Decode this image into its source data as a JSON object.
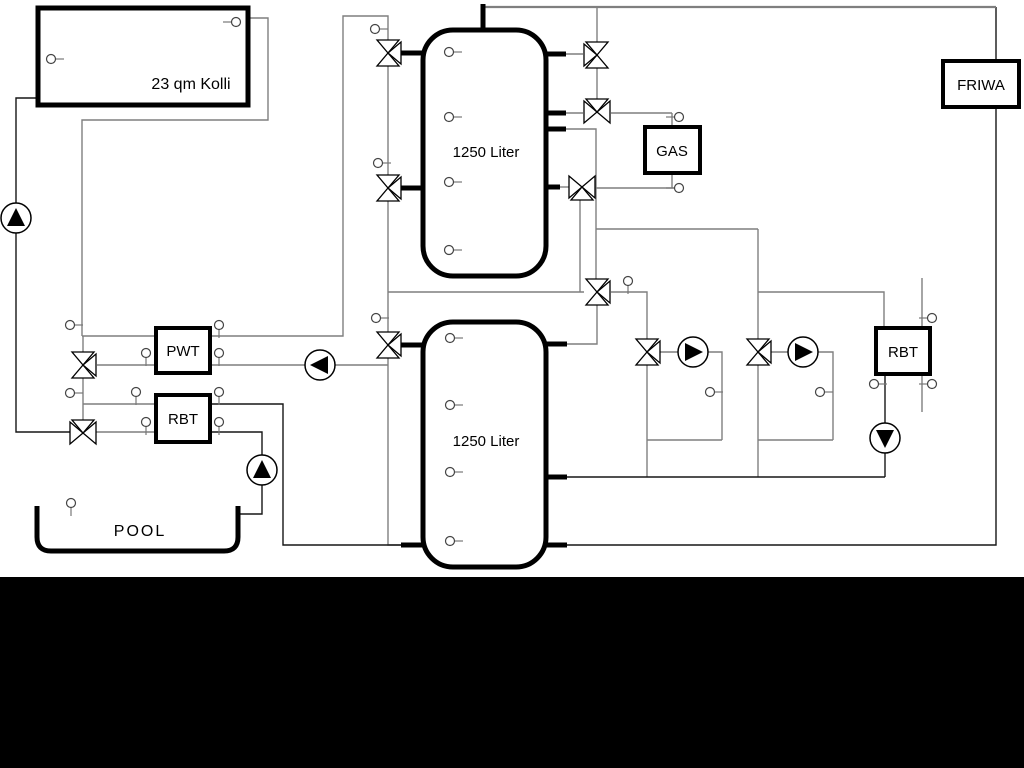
{
  "diagram": {
    "title_note": "hydraulic heating scheme",
    "labels": {
      "collector": "23 qm Kolli",
      "tank_top": "1250 Liter",
      "tank_bottom": "1250 Liter",
      "pwt": "PWT",
      "rbt_pool": "RBT",
      "gas": "GAS",
      "rbt_right": "RBT",
      "friwa": "FRIWA",
      "pool": "POOL"
    },
    "colors": {
      "pipe_gray": "#7f7f7f",
      "pipe_dark": "#161616",
      "line_black": "#000000",
      "background": "#ffffff",
      "letterbox": "#000000"
    },
    "icons": {
      "pump": "pump-icon",
      "valve": "three-way-valve-icon",
      "sensor": "temperature-sensor-icon"
    }
  }
}
